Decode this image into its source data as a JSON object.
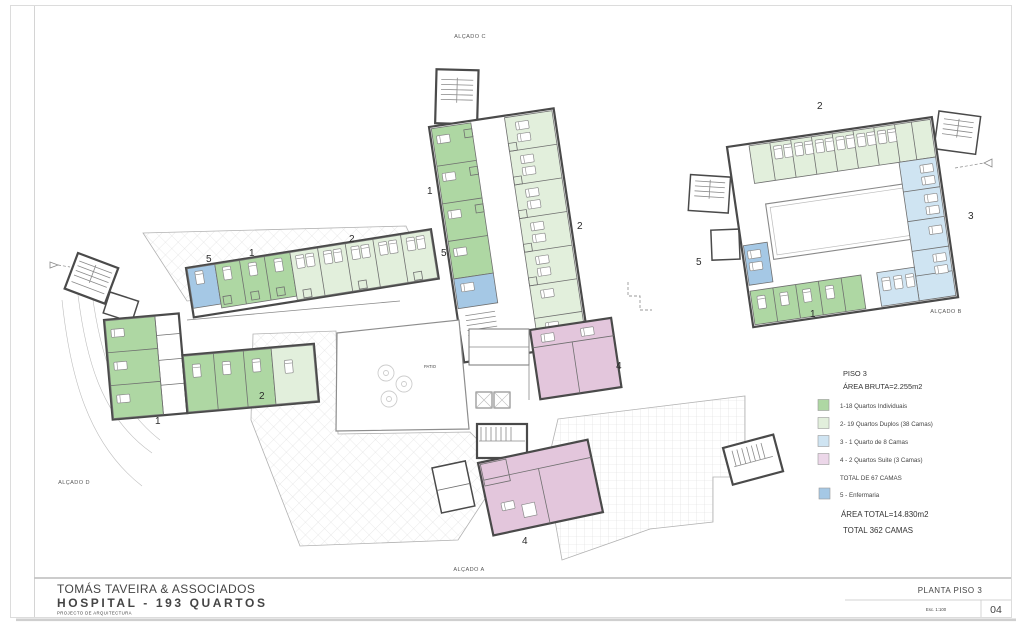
{
  "sheet": {
    "firm": "TOMÁS TAVEIRA & ASSOCIADOS",
    "project": "HOSPITAL - 193 QUARTOS",
    "discipline": "PROJECTO DE ARQUITECTURA",
    "drawing_title": "PLANTA PISO 3",
    "scale": "Esc. 1:100",
    "sheet_number": "04"
  },
  "elevations": {
    "a": "ALÇADO A",
    "b": "ALÇADO B",
    "c": "ALÇADO C",
    "d": "ALÇADO D"
  },
  "legend": {
    "floor": "PISO 3",
    "gross_area": "ÁREA BRUTA=2.255m2",
    "items": [
      {
        "num": "1",
        "label": "1-18 Quartos Individuais",
        "color": "#aed7a3"
      },
      {
        "num": "2",
        "label": "2- 19 Quartos Duplos (38 Camas)",
        "color": "#e2efdc"
      },
      {
        "num": "3",
        "label": "3 - 1 Quarto de 8 Camas",
        "color": "#cfe4f2"
      },
      {
        "num": "4",
        "label": "4 - 2 Quartos Suite (3 Camas)",
        "color": "#ecd7e9"
      }
    ],
    "total_beds_floor": "TOTAL DE 67 CAMAS",
    "nursing": {
      "num": "5",
      "label": "5 - Enfermaria",
      "color": "#a5c8e5"
    },
    "total_area": "ÁREA TOTAL=14.830m2",
    "total_beds_building": "TOTAL 362 CAMAS"
  },
  "markers": {
    "individuais": "1",
    "duplos": "2",
    "oito_camas": "3",
    "suite": "4",
    "enfermaria": "5"
  },
  "plan": {
    "patio_label": "PATIO",
    "colors": {
      "walls": "#4a4a4a",
      "suite_room": "#e3c6dc"
    }
  }
}
